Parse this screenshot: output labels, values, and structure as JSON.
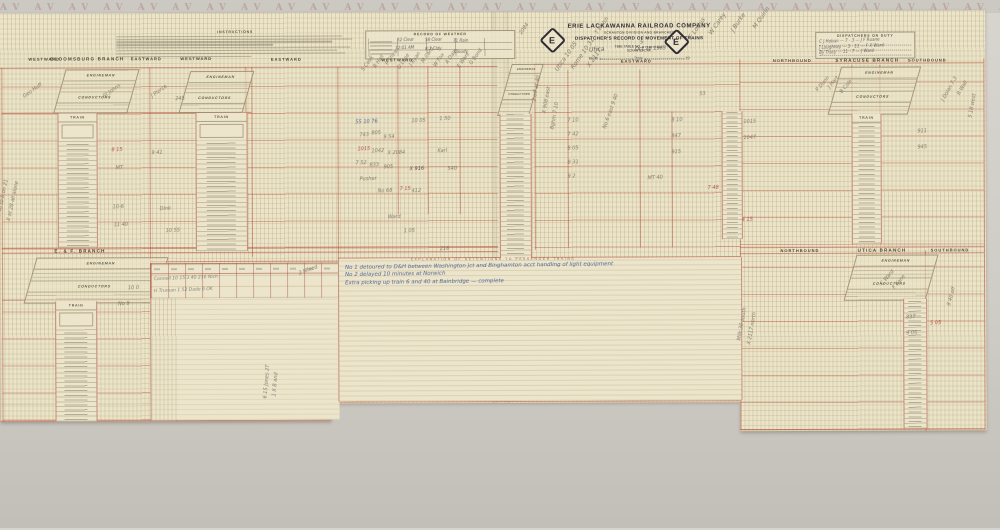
{
  "palette": {
    "paper": "#ebe4c8",
    "red_rule": "#b85a46",
    "pencil": "#6e695c",
    "ink": "#3f3c46",
    "red_ink": "#a83a2c",
    "blue_ink": "#33508f"
  },
  "top_strip": {
    "pattern": "AV AV AV AV AV AV AV AV AV AV AV AV AV AV AV AV AV AV AV AV AV AV AV AV AV AV AV AV AV AV AV AV AV AV AV AV"
  },
  "labels": {
    "engineman": "ENGINEMAN",
    "conductors": "CONDUCTORS",
    "train": "TRAIN"
  },
  "headers": {
    "top": [
      "WESTWARD",
      "BLOOMSBURG BRANCH",
      "EASTWARD",
      "WESTWARD",
      "EASTWARD",
      "WESTWARD",
      "EASTWARD",
      "NORTHBOUND",
      "SYRACUSE BRANCH",
      "SOUTHBOUND"
    ],
    "mid": [
      "E. & F. BRANCH",
      "NORTHBOUND",
      "UTICA BRANCH",
      "SOUTHBOUND"
    ]
  },
  "title_block": {
    "company": "ERIE LACKAWANNA RAILROAD COMPANY",
    "division": "SCRANTON DIVISION AND BRANCHES",
    "record": "DISPATCHER'S RECORD OF MOVEMENT OF TRAINS",
    "timetable_label": "TIME TABLE NO.",
    "location": "SCRANTON, PA.",
    "from_label": "From",
    "date_label": "Date",
    "year_label": "19"
  },
  "boxes": {
    "instructions": {
      "title": "INSTRUCTIONS"
    },
    "weather": {
      "title": "RECORD OF WEATHER"
    },
    "dispatchers": {
      "title": "DISPATCHERS ON DUTY"
    }
  },
  "explanation": {
    "caption": "EXPLANATION OF DETENTIONS TO PASSENGER TRAINS"
  },
  "notes": {
    "lines": [
      "No 1 detoured to D&H between Washington Jct and Binghamton acct handling of light equipment",
      "No 2 delayed 10 minutes at Norwich",
      "Extra picking up train 6 and 40 at Bainbridge — complete"
    ]
  },
  "handwriting": [
    {
      "t": "5",
      "x": 641,
      "y": 40,
      "r": -2,
      "c": "i",
      "s": 5
    },
    {
      "t": "Utica",
      "x": 590,
      "y": 47,
      "r": -3,
      "c": "i",
      "s": 6
    },
    {
      "t": "Oct 28 1963",
      "x": 636,
      "y": 47,
      "r": -2,
      "c": "i",
      "s": 5
    },
    {
      "t": "E Loftus",
      "x": 694,
      "y": 34,
      "r": -55,
      "c": "p",
      "s": 6
    },
    {
      "t": "W Carey",
      "x": 714,
      "y": 30,
      "r": -55,
      "c": "p",
      "s": 6
    },
    {
      "t": "J Burke",
      "x": 736,
      "y": 27,
      "r": -55,
      "c": "p",
      "s": 6
    },
    {
      "t": "M Quinn",
      "x": 758,
      "y": 24,
      "r": -55,
      "c": "p",
      "s": 6
    },
    {
      "t": "2084",
      "x": 524,
      "y": 30,
      "r": -55,
      "c": "p",
      "s": 5
    },
    {
      "t": "T Walsh",
      "x": 600,
      "y": 30,
      "r": -55,
      "c": "p",
      "s": 5
    },
    {
      "t": "C J Hoban — 7 - 3 — J F Ruane",
      "x": 820,
      "y": 40,
      "r": -2,
      "c": "i",
      "s": 4
    },
    {
      "t": "J Loughney — 3 - 11 — F X Ward",
      "x": 820,
      "y": 46,
      "r": -2,
      "c": "i",
      "s": 4
    },
    {
      "t": "By Tracy — 11 - 7 — J Ward",
      "x": 820,
      "y": 51,
      "r": -2,
      "c": "i",
      "s": 4
    },
    {
      "t": "52 Clear",
      "x": 398,
      "y": 37,
      "r": 0,
      "c": "i",
      "s": 4
    },
    {
      "t": "58 Clear",
      "x": 426,
      "y": 37,
      "r": 0,
      "c": "i",
      "s": 4
    },
    {
      "t": "71 Rain",
      "x": 454,
      "y": 38,
      "r": 0,
      "c": "i",
      "s": 4
    },
    {
      "t": "12:01 AM",
      "x": 396,
      "y": 45,
      "r": 0,
      "c": "i",
      "s": 4
    },
    {
      "t": "8:1 Cldy",
      "x": 426,
      "y": 46,
      "r": 0,
      "c": "i",
      "s": 4
    },
    {
      "t": "Cloudy",
      "x": 455,
      "y": 49,
      "r": 0,
      "c": "i",
      "s": 4
    },
    {
      "t": "8-40 to 8 on 21",
      "x": 2,
      "y": 210,
      "r": -78,
      "c": "p",
      "s": 5
    },
    {
      "t": "X at 28 all alone",
      "x": 12,
      "y": 214,
      "r": -78,
      "c": "p",
      "s": 5
    },
    {
      "t": "Geo Huff",
      "x": 26,
      "y": 92,
      "r": -35,
      "c": "p",
      "s": 5
    },
    {
      "t": "St Johns",
      "x": 106,
      "y": 92,
      "r": -35,
      "c": "p",
      "s": 5
    },
    {
      "t": "8 15",
      "x": 112,
      "y": 146,
      "r": 0,
      "c": "r",
      "s": 5
    },
    {
      "t": "MT",
      "x": 116,
      "y": 164,
      "r": 0,
      "c": "p",
      "s": 5
    },
    {
      "t": "10-6",
      "x": 113,
      "y": 203,
      "r": 0,
      "c": "p",
      "s": 5
    },
    {
      "t": "11 40",
      "x": 114,
      "y": 221,
      "r": 0,
      "c": "p",
      "s": 5
    },
    {
      "t": "J Pierce",
      "x": 154,
      "y": 92,
      "r": -35,
      "c": "p",
      "s": 5
    },
    {
      "t": "245",
      "x": 176,
      "y": 95,
      "r": 0,
      "c": "p",
      "s": 5
    },
    {
      "t": "9 41",
      "x": 152,
      "y": 149,
      "r": 0,
      "c": "p",
      "s": 5
    },
    {
      "t": "Dink",
      "x": 160,
      "y": 205,
      "r": 0,
      "c": "p",
      "s": 5
    },
    {
      "t": "10 55",
      "x": 166,
      "y": 227,
      "r": 0,
      "c": "p",
      "s": 5
    },
    {
      "t": "S Cook",
      "x": 366,
      "y": 66,
      "r": -55,
      "c": "p",
      "s": 5
    },
    {
      "t": "R Hall",
      "x": 378,
      "y": 63,
      "r": -55,
      "c": "p",
      "s": 5
    },
    {
      "t": "P Shea",
      "x": 390,
      "y": 60,
      "r": -55,
      "c": "p",
      "s": 5
    },
    {
      "t": "D Lane",
      "x": 402,
      "y": 64,
      "r": -55,
      "c": "p",
      "s": 5
    },
    {
      "t": "J Ryan",
      "x": 414,
      "y": 61,
      "r": -55,
      "c": "p",
      "s": 5
    },
    {
      "t": "M Card",
      "x": 426,
      "y": 58,
      "r": -55,
      "c": "p",
      "s": 5
    },
    {
      "t": "W Fox",
      "x": 438,
      "y": 62,
      "r": -55,
      "c": "p",
      "s": 5
    },
    {
      "t": "A Dale",
      "x": 450,
      "y": 59,
      "r": -55,
      "c": "p",
      "s": 5
    },
    {
      "t": "E Ware",
      "x": 462,
      "y": 63,
      "r": -55,
      "c": "p",
      "s": 5
    },
    {
      "t": "G Bond",
      "x": 474,
      "y": 60,
      "r": -55,
      "c": "p",
      "s": 5
    },
    {
      "t": "55 10 76",
      "x": 356,
      "y": 119,
      "r": 0,
      "c": "b",
      "s": 5
    },
    {
      "t": "743",
      "x": 360,
      "y": 132,
      "r": 0,
      "c": "p",
      "s": 5
    },
    {
      "t": "805",
      "x": 372,
      "y": 130,
      "r": 0,
      "c": "p",
      "s": 5
    },
    {
      "t": "9 54",
      "x": 384,
      "y": 134,
      "r": 0,
      "c": "p",
      "s": 5
    },
    {
      "t": "10 05",
      "x": 412,
      "y": 118,
      "r": 0,
      "c": "p",
      "s": 5
    },
    {
      "t": "1 50",
      "x": 440,
      "y": 116,
      "r": 0,
      "c": "p",
      "s": 5
    },
    {
      "t": "1015",
      "x": 358,
      "y": 146,
      "r": 0,
      "c": "r",
      "s": 5
    },
    {
      "t": "1042",
      "x": 372,
      "y": 148,
      "r": 0,
      "c": "p",
      "s": 5
    },
    {
      "t": "X 2084",
      "x": 388,
      "y": 150,
      "r": 0,
      "c": "p",
      "s": 5
    },
    {
      "t": "Karl",
      "x": 438,
      "y": 148,
      "r": 0,
      "c": "p",
      "s": 5
    },
    {
      "t": "7 52",
      "x": 356,
      "y": 160,
      "r": 0,
      "c": "p",
      "s": 5
    },
    {
      "t": "833",
      "x": 370,
      "y": 162,
      "r": 0,
      "c": "p",
      "s": 5
    },
    {
      "t": "905",
      "x": 384,
      "y": 164,
      "r": 0,
      "c": "p",
      "s": 5
    },
    {
      "t": "X 916",
      "x": 410,
      "y": 166,
      "r": 0,
      "c": "i",
      "s": 5
    },
    {
      "t": "540",
      "x": 448,
      "y": 166,
      "r": 0,
      "c": "p",
      "s": 5
    },
    {
      "t": "Pusher",
      "x": 360,
      "y": 176,
      "r": 0,
      "c": "p",
      "s": 5
    },
    {
      "t": "No 68",
      "x": 378,
      "y": 188,
      "r": 0,
      "c": "p",
      "s": 5
    },
    {
      "t": "7 15",
      "x": 400,
      "y": 186,
      "r": 0,
      "c": "r",
      "s": 5
    },
    {
      "t": "412",
      "x": 412,
      "y": 188,
      "r": 0,
      "c": "p",
      "s": 5
    },
    {
      "t": "Ward",
      "x": 388,
      "y": 214,
      "r": 0,
      "c": "p",
      "s": 5
    },
    {
      "t": "1 05",
      "x": 404,
      "y": 228,
      "r": 0,
      "c": "p",
      "s": 5
    },
    {
      "t": "216",
      "x": 440,
      "y": 246,
      "r": 0,
      "c": "p",
      "s": 5
    },
    {
      "t": "Utica 10 05",
      "x": 560,
      "y": 66,
      "r": -55,
      "c": "p",
      "s": 6
    },
    {
      "t": "Rome 10 31",
      "x": 576,
      "y": 64,
      "r": -55,
      "c": "p",
      "s": 6
    },
    {
      "t": "X 2117",
      "x": 592,
      "y": 62,
      "r": -55,
      "c": "p",
      "s": 6
    },
    {
      "t": "2 off at 40",
      "x": 538,
      "y": 96,
      "r": -80,
      "c": "p",
      "s": 5
    },
    {
      "t": "X 908 east",
      "x": 548,
      "y": 108,
      "r": -80,
      "c": "p",
      "s": 5
    },
    {
      "t": "Bghm 7 10",
      "x": 556,
      "y": 124,
      "r": -80,
      "c": "p",
      "s": 5
    },
    {
      "t": "7 10",
      "x": 568,
      "y": 118,
      "r": 0,
      "c": "p",
      "s": 5
    },
    {
      "t": "7 42",
      "x": 568,
      "y": 132,
      "r": 0,
      "c": "p",
      "s": 5
    },
    {
      "t": "8 05",
      "x": 568,
      "y": 146,
      "r": 0,
      "c": "p",
      "s": 5
    },
    {
      "t": "8 31",
      "x": 568,
      "y": 160,
      "r": 0,
      "c": "p",
      "s": 5
    },
    {
      "t": "9 2",
      "x": 568,
      "y": 174,
      "r": 0,
      "c": "p",
      "s": 5
    },
    {
      "t": "No 6 east 9 40",
      "x": 608,
      "y": 124,
      "r": -70,
      "c": "p",
      "s": 5
    },
    {
      "t": "53",
      "x": 700,
      "y": 92,
      "r": 0,
      "c": "p",
      "s": 5
    },
    {
      "t": "8 10",
      "x": 672,
      "y": 118,
      "r": 0,
      "c": "p",
      "s": 5
    },
    {
      "t": "847",
      "x": 672,
      "y": 134,
      "r": 0,
      "c": "p",
      "s": 5
    },
    {
      "t": "915",
      "x": 672,
      "y": 150,
      "r": 0,
      "c": "p",
      "s": 5
    },
    {
      "t": "MT 40",
      "x": 648,
      "y": 176,
      "r": -3,
      "c": "p",
      "s": 5
    },
    {
      "t": "7 48",
      "x": 708,
      "y": 186,
      "r": 0,
      "c": "r",
      "s": 5
    },
    {
      "t": "P Dunn",
      "x": 820,
      "y": 88,
      "r": -50,
      "c": "p",
      "s": 5
    },
    {
      "t": "J Hart",
      "x": 832,
      "y": 85,
      "r": -50,
      "c": "p",
      "s": 5
    },
    {
      "t": "B Cole",
      "x": 844,
      "y": 90,
      "r": -50,
      "c": "p",
      "s": 5
    },
    {
      "t": "1015",
      "x": 744,
      "y": 120,
      "r": 0,
      "c": "p",
      "s": 5
    },
    {
      "t": "1047",
      "x": 744,
      "y": 136,
      "r": 0,
      "c": "p",
      "s": 5
    },
    {
      "t": "4 15",
      "x": 742,
      "y": 218,
      "r": 0,
      "c": "r",
      "s": 5
    },
    {
      "t": "J Dolan 7-3",
      "x": 946,
      "y": 98,
      "r": -60,
      "c": "p",
      "s": 5
    },
    {
      "t": "R Wall",
      "x": 962,
      "y": 92,
      "r": -60,
      "c": "p",
      "s": 5
    },
    {
      "t": "5 18 west",
      "x": 974,
      "y": 114,
      "r": -80,
      "c": "p",
      "s": 5
    },
    {
      "t": "911",
      "x": 918,
      "y": 130,
      "r": 0,
      "c": "p",
      "s": 5
    },
    {
      "t": "945",
      "x": 918,
      "y": 146,
      "r": 0,
      "c": "p",
      "s": 5
    },
    {
      "t": "10 0",
      "x": 128,
      "y": 284,
      "r": 0,
      "c": "p",
      "s": 5
    },
    {
      "t": "No 9",
      "x": 118,
      "y": 300,
      "r": 0,
      "c": "p",
      "s": 5
    },
    {
      "t": "Connell   10 15   3 40   216   Nich",
      "x": 154,
      "y": 276,
      "r": 0,
      "c": "p",
      "s": 4.5
    },
    {
      "t": "H Truman   1 52   Dade   6   OK",
      "x": 154,
      "y": 288,
      "r": 0,
      "c": "p",
      "s": 4.5
    },
    {
      "t": "2 Mixed",
      "x": 300,
      "y": 270,
      "r": -20,
      "c": "p",
      "s": 5
    },
    {
      "t": "6 15 Jones 2T",
      "x": 268,
      "y": 392,
      "r": -85,
      "c": "p",
      "s": 5
    },
    {
      "t": "1 X B and",
      "x": 277,
      "y": 390,
      "r": -85,
      "c": "p",
      "s": 5
    },
    {
      "t": "Milk 30 south",
      "x": 742,
      "y": 336,
      "r": -80,
      "c": "p",
      "s": 5
    },
    {
      "t": "X 2117 north",
      "x": 752,
      "y": 340,
      "r": -80,
      "c": "p",
      "s": 5
    },
    {
      "t": "C Ward",
      "x": 884,
      "y": 282,
      "r": -50,
      "c": "p",
      "s": 5
    },
    {
      "t": "F Kane",
      "x": 896,
      "y": 286,
      "r": -50,
      "c": "p",
      "s": 5
    },
    {
      "t": "837",
      "x": 906,
      "y": 316,
      "r": 0,
      "c": "p",
      "s": 5
    },
    {
      "t": "9 05",
      "x": 906,
      "y": 332,
      "r": 0,
      "c": "p",
      "s": 5
    },
    {
      "t": "5 05",
      "x": 930,
      "y": 322,
      "r": 0,
      "c": "r",
      "s": 5
    },
    {
      "t": "8 40 off",
      "x": 952,
      "y": 302,
      "r": -75,
      "c": "p",
      "s": 5
    }
  ]
}
